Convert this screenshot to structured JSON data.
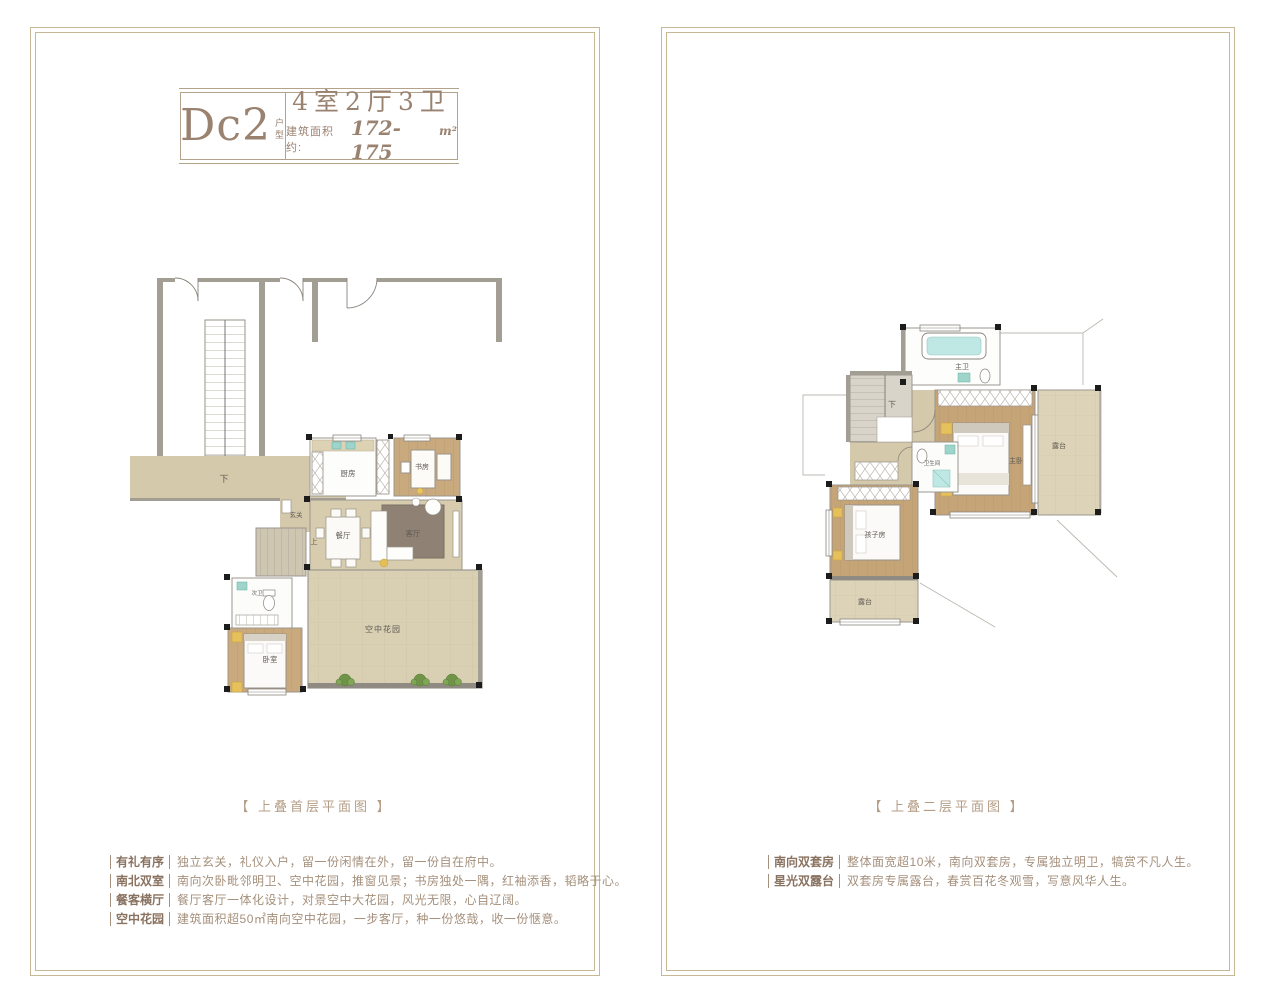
{
  "page": {
    "background": "#ffffff"
  },
  "colors": {
    "frame": "#c6b894",
    "heading": "#9a8270",
    "caption": "#b49d86",
    "bullet_label": "#8a7260",
    "bullet_text": "#a5907c",
    "wood_floor": "#c5a478",
    "tile_floor": "#d8ccae",
    "garden_floor": "#d9d0b4",
    "plant_green": "#6f9448",
    "water_teal": "#bfe8e4",
    "wall_gray": "#a39e94"
  },
  "header": {
    "unit_code": "Dc2",
    "unit_code_suffix": "户型",
    "layout": "4室2厅3卫",
    "area_label": "建筑面积约:",
    "area_value": "172-175",
    "area_unit": "m²"
  },
  "left_panel": {
    "caption": "【 上叠首层平面图 】",
    "rooms": {
      "down": "下",
      "kitchen": "厨房",
      "study": "书房",
      "foyer": "玄关",
      "dining": "餐厅",
      "living": "客厅",
      "up": "上",
      "bath": "次卫",
      "bedroom": "卧室",
      "sky_garden": "空中花园"
    },
    "bullets": [
      {
        "label": "有礼有序",
        "text": "独立玄关，礼仪入户，留一份闲情在外，留一份自在府中。"
      },
      {
        "label": "南北双室",
        "text": "南向次卧毗邻明卫、空中花园，推窗见景；书房独处一隅，红袖添香，韬略于心。"
      },
      {
        "label": "餐客横厅",
        "text": "餐厅客厅一体化设计，对景空中大花园，风光无限，心自辽阔。"
      },
      {
        "label": "空中花园",
        "text": "建筑面积超50㎡南向空中花园，一步客厅，种一份悠哉，收一份惬意。"
      }
    ]
  },
  "right_panel": {
    "caption": "【 上叠二层平面图 】",
    "rooms": {
      "master_bath": "主卫",
      "master_bedroom": "主卧",
      "terrace_right": "露台",
      "down": "下",
      "bathroom": "卫生间",
      "kids_room": "孩子房",
      "terrace_bottom": "露台"
    },
    "bullets": [
      {
        "label": "南向双套房",
        "text": "整体面宽超10米，南向双套房，专属独立明卫，犒赏不凡人生。"
      },
      {
        "label": "星光双露台",
        "text": "双套房专属露台，春赏百花冬观雪，写意风华人生。"
      }
    ]
  }
}
